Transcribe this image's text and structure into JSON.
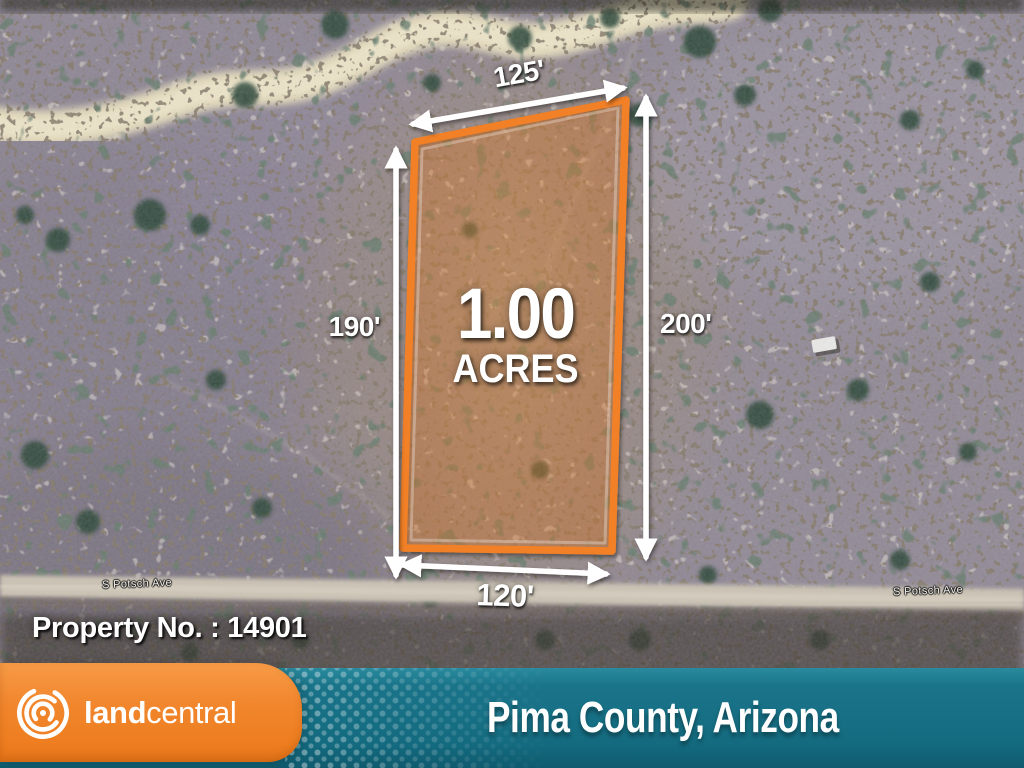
{
  "map": {
    "road_labels": {
      "left": "S Potsch Ave",
      "right": "S Potsch Ave"
    }
  },
  "parcel": {
    "acreage_value": "1.00",
    "acreage_unit": "ACRES",
    "dimensions": {
      "top": "125'",
      "left": "190'",
      "right": "200'",
      "bottom": "120'"
    },
    "outline_color": "#f18027",
    "fill_color": "rgba(240,130,48,0.30)"
  },
  "property": {
    "number_label": "Property No. : 14901"
  },
  "footer": {
    "brand": {
      "bold": "land",
      "regular": "central"
    },
    "location": "Pima County, Arizona",
    "colors": {
      "orange": "#f08230",
      "teal": "#167189"
    }
  }
}
